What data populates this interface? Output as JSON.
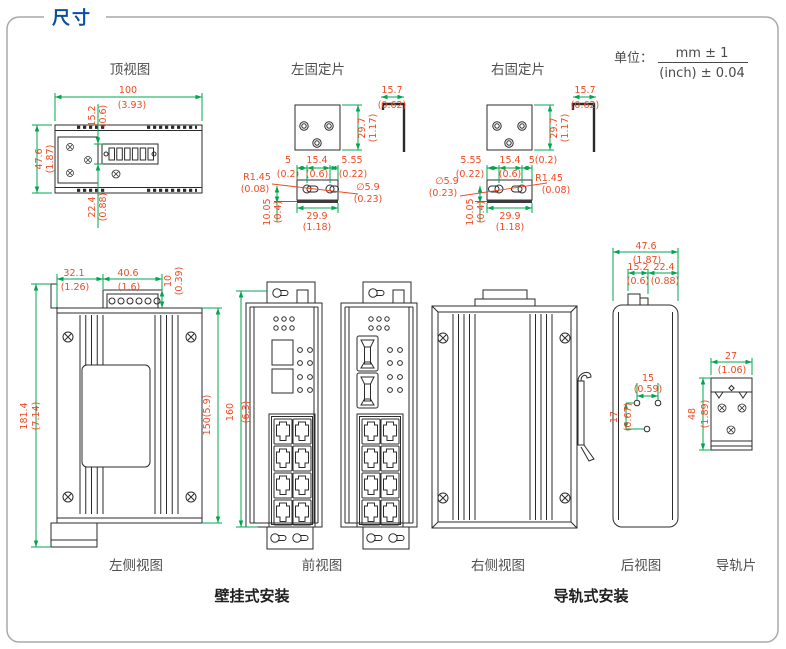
{
  "title": "尺寸",
  "unit": {
    "label": "单位：",
    "mm_tol": "mm ± 1",
    "inch_tol": "(inch) ± 0.04"
  },
  "captions": {
    "top_view": "顶视图",
    "left_plate": "左固定片",
    "right_plate": "右固定片",
    "left_side_view": "左侧视图",
    "front_view": "前视图",
    "right_side_view": "右侧视图",
    "rear_view": "后视图",
    "rail_plate": "导轨片",
    "wall_mount": "壁挂式安装",
    "rail_mount": "导轨式安装"
  },
  "dims": {
    "top": {
      "width": {
        "mm": "100",
        "inch": "(3.93)"
      },
      "top_offset": {
        "mm": "15.2",
        "inch": "(0.6)"
      },
      "depth": {
        "mm": "47.6",
        "inch": "(1.87)"
      },
      "bottom_offset": {
        "mm": "22.4",
        "inch": "(0.88)"
      }
    },
    "left_plate": {
      "tab": {
        "mm": "15.7",
        "inch": "(0.62)"
      },
      "height": {
        "mm": "29.7",
        "inch": "(1.17)"
      },
      "edge": {
        "mm": "5",
        "inch": "(0.2)"
      },
      "pitch": {
        "mm": "15.4",
        "inch": "(0.6)"
      },
      "end": {
        "mm": "5.55",
        "inch": "(0.22)"
      },
      "radius": {
        "mm": "R1.45",
        "inch": "(0.08)"
      },
      "hole": {
        "mm": "∅5.9",
        "inch": "(0.23)"
      },
      "thickness": {
        "mm": "10.05",
        "inch": "(0.4)"
      },
      "width": {
        "mm": "29.9",
        "inch": "(1.18)"
      }
    },
    "right_plate": {
      "tab": {
        "mm": "15.7",
        "inch": "(0.62)"
      },
      "height": {
        "mm": "29.7",
        "inch": "(1.17)"
      },
      "end": {
        "mm": "5.55",
        "inch": "(0.22)"
      },
      "pitch": {
        "mm": "15.4",
        "inch": "(0.6)"
      },
      "edge": {
        "mm": "5(0.2)"
      },
      "radius": {
        "mm": "R1.45",
        "inch": "(0.08)"
      },
      "hole": {
        "mm": "∅5.9",
        "inch": "(0.23)"
      },
      "thickness": {
        "mm": "10.05",
        "inch": "(0.4)"
      },
      "width": {
        "mm": "29.9",
        "inch": "(1.18)"
      }
    },
    "left_side": {
      "left_seg": {
        "mm": "32.1",
        "inch": "(1.26)"
      },
      "terminal_w": {
        "mm": "40.6",
        "inch": "(1.6)"
      },
      "terminal_h": {
        "mm": "10",
        "inch": "(0.39)"
      },
      "total_h": {
        "mm": "181.4",
        "inch": "(7.14)"
      },
      "body_h": {
        "mm": "150(5.9)"
      }
    },
    "front": {
      "height": {
        "mm": "160",
        "inch": "(6.3)"
      }
    },
    "rear": {
      "width": {
        "mm": "47.6",
        "inch": "(1.87)"
      },
      "clip_w": {
        "mm": "15.2",
        "inch": "(0.6)"
      },
      "clip_offset": {
        "mm": "22.4",
        "inch": "(0.88)"
      },
      "hole_pitch": {
        "mm": "15",
        "inch": "(0.59)"
      },
      "hole_v": {
        "mm": "17",
        "inch": "(0.67)"
      }
    },
    "rail": {
      "width": {
        "mm": "27",
        "inch": "(1.06)"
      },
      "height": {
        "mm": "48",
        "inch": "(1.89)"
      }
    }
  },
  "colors": {
    "dimension_line": "#00a54f",
    "dimension_text": "#ee4a23",
    "drawing_line": "#2b2b2b",
    "title": "#0d4f9e",
    "border": "#a8a8a8"
  }
}
